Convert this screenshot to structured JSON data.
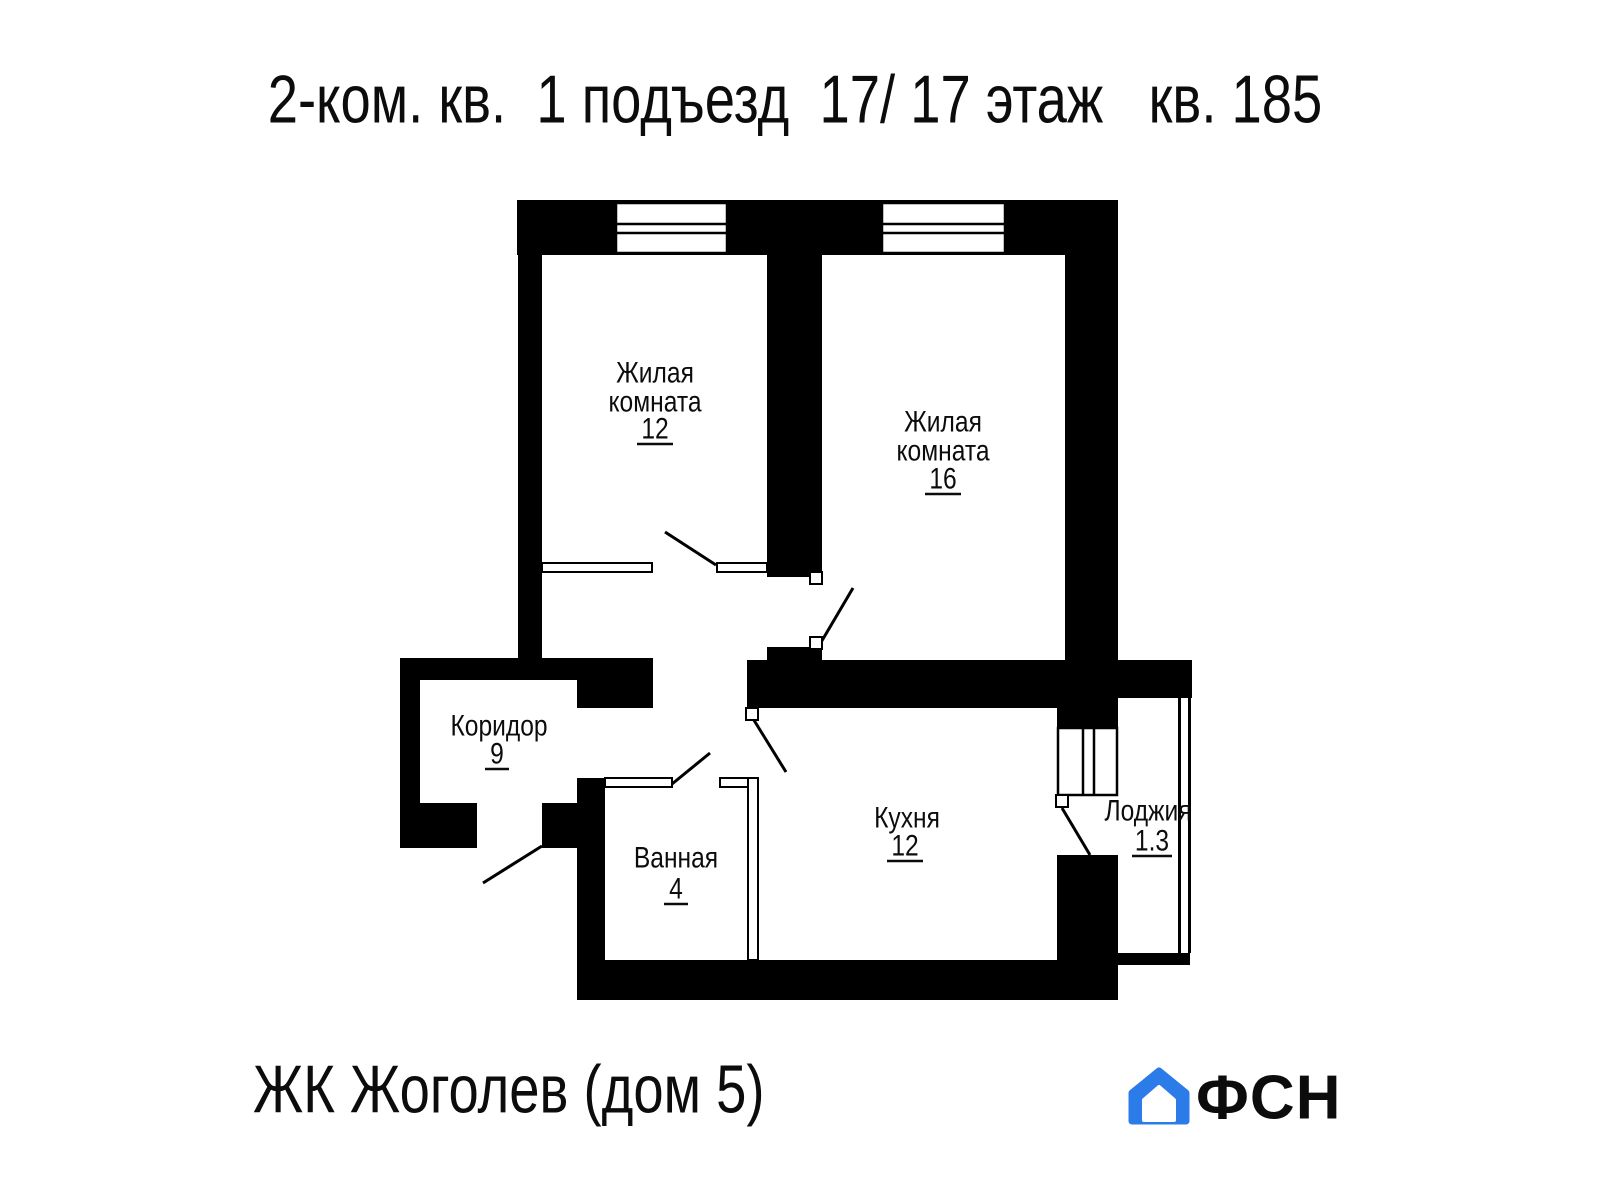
{
  "title": "2-ком. кв.  1 подъезд  17/ 17 этаж   кв. 185",
  "rooms": {
    "living12": {
      "line1": "Жилая",
      "line2": "комната",
      "area": "12"
    },
    "living16": {
      "line1": "Жилая",
      "line2": "комната",
      "area": "16"
    },
    "corridor": {
      "line1": "Коридор",
      "area": "9"
    },
    "bathroom": {
      "line1": "Ванная",
      "area": "4"
    },
    "kitchen": {
      "line1": "Кухня",
      "area": "12"
    },
    "loggia": {
      "line1": "Лоджия",
      "area": "1.3"
    }
  },
  "footer": {
    "project": "ЖК Жоголев (дом 5)"
  },
  "logo": {
    "text": "ФСН"
  },
  "colors": {
    "walls": "#000000",
    "background": "#ffffff",
    "logo_blue": "#2b7ce9",
    "logo_text": "#23252b"
  }
}
